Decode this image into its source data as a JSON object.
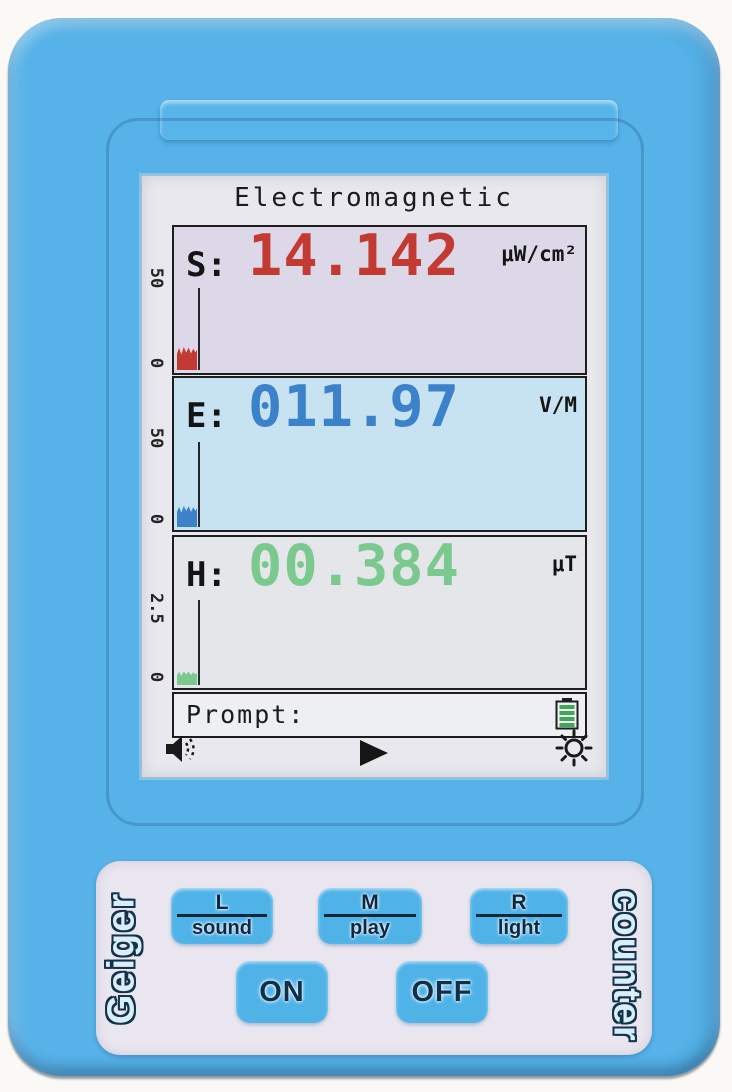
{
  "device": {
    "type_label_left": "Geiger",
    "type_label_right": "counter",
    "colors": {
      "body_blue": "#56b2e8",
      "button_blue": "#4fb3e8",
      "keypad_panel": "#eae6f0",
      "lcd_bg": "#e9e8ee",
      "s_color": "#c23a31",
      "e_color": "#3b82cb",
      "h_color": "#7cc98f",
      "s_chart_bg": "#ddd8e8",
      "e_chart_bg": "#c7e2f1",
      "h_chart_bg": "#e4e6e9",
      "battery_green": "#3fa757"
    }
  },
  "screen": {
    "title": "Electromagnetic",
    "readings": [
      {
        "label": "S:",
        "value": "14.142",
        "unit": "μW/cm²",
        "axis_max": "50",
        "axis_min": "0"
      },
      {
        "label": "E:",
        "value": "011.97",
        "unit": "V/M",
        "axis_max": "50",
        "axis_min": "0"
      },
      {
        "label": "H:",
        "value": "00.384",
        "unit": "μT",
        "axis_max": "2.5",
        "axis_min": "0"
      }
    ],
    "prompt_label": "Prompt:",
    "status_icons": {
      "left": "speaker",
      "center": "play",
      "right": "brightness",
      "battery": "battery-full"
    }
  },
  "keypad": {
    "function_buttons": [
      {
        "key": "L",
        "label": "sound"
      },
      {
        "key": "M",
        "label": "play"
      },
      {
        "key": "R",
        "label": "light"
      }
    ],
    "power_buttons": [
      {
        "label": "ON"
      },
      {
        "label": "OFF"
      }
    ]
  },
  "chart_data": [
    {
      "type": "bar",
      "series_label": "S power density trend",
      "ylim": [
        0,
        50
      ],
      "tick_labels": [
        "50",
        "0"
      ],
      "current_reading": 14.142,
      "unit": "μW/cm²"
    },
    {
      "type": "bar",
      "series_label": "E electric field trend",
      "ylim": [
        0,
        50
      ],
      "tick_labels": [
        "50",
        "0"
      ],
      "current_reading": 11.97,
      "unit": "V/M"
    },
    {
      "type": "bar",
      "series_label": "H magnetic field trend",
      "ylim": [
        0,
        2.5
      ],
      "tick_labels": [
        "2.5",
        "0"
      ],
      "current_reading": 0.384,
      "unit": "μT"
    }
  ]
}
